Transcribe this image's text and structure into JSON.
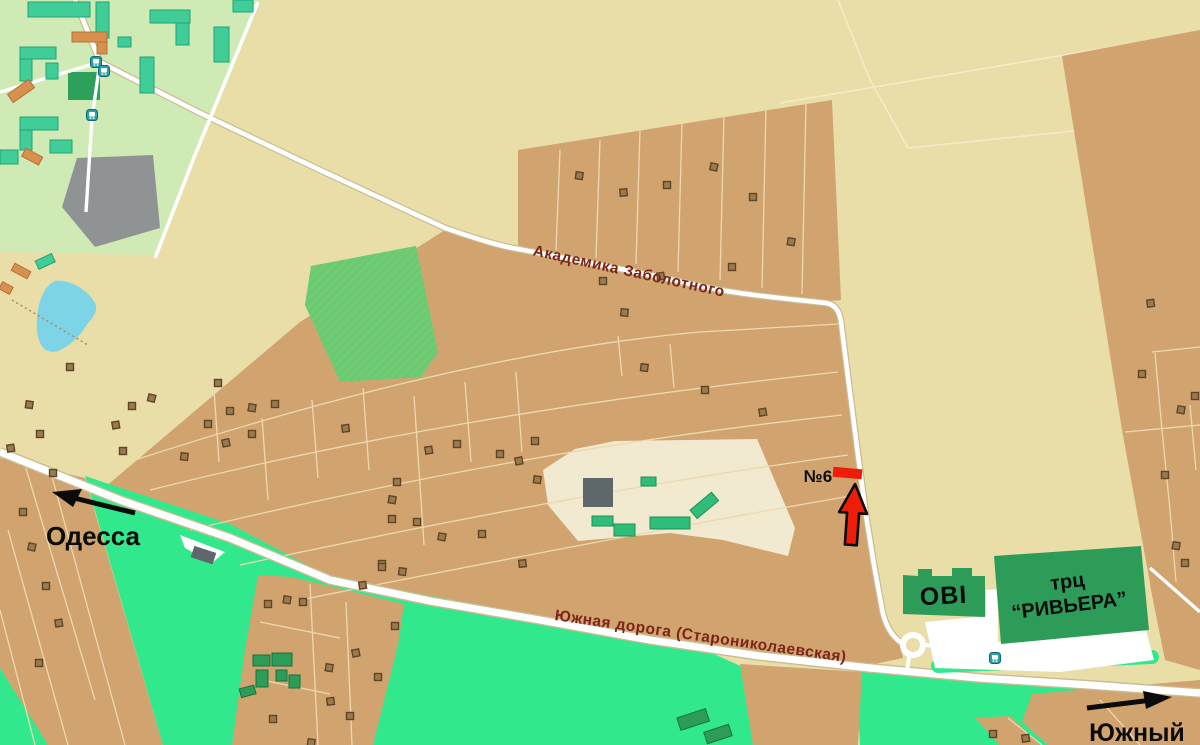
{
  "map": {
    "title": "Схема проезда — №6, Южная дорога",
    "labels": {
      "street_1": "Академика Заболотного",
      "street_2": "Южная дорога (Старониколаевская)",
      "dir_left": "Одесса",
      "dir_right": "Южный",
      "marker": "№6",
      "store_obi": "OBI",
      "mall_line1": "трц",
      "mall_line2": "“РИВЬЕРА”"
    },
    "icons": [
      "bus-stop-icon",
      "destination-arrow-icon",
      "odessa-direction-arrow-icon",
      "yuzhny-direction-arrow-icon"
    ],
    "colors": {
      "land": "#e9dda8",
      "plots_brown": "#d1a46f",
      "fields_green": "#31e98c",
      "residential_green": "#cfeab4",
      "building_green": "#2d9c59",
      "building_teal": "#40cd98",
      "building_orange": "#d8904f",
      "water_blue": "#7cd4e6",
      "industrial_gray": "#8f9394",
      "road_white": "#ffffff",
      "street_label_red": "#7c2418",
      "marker_red": "#ee1d09"
    }
  }
}
